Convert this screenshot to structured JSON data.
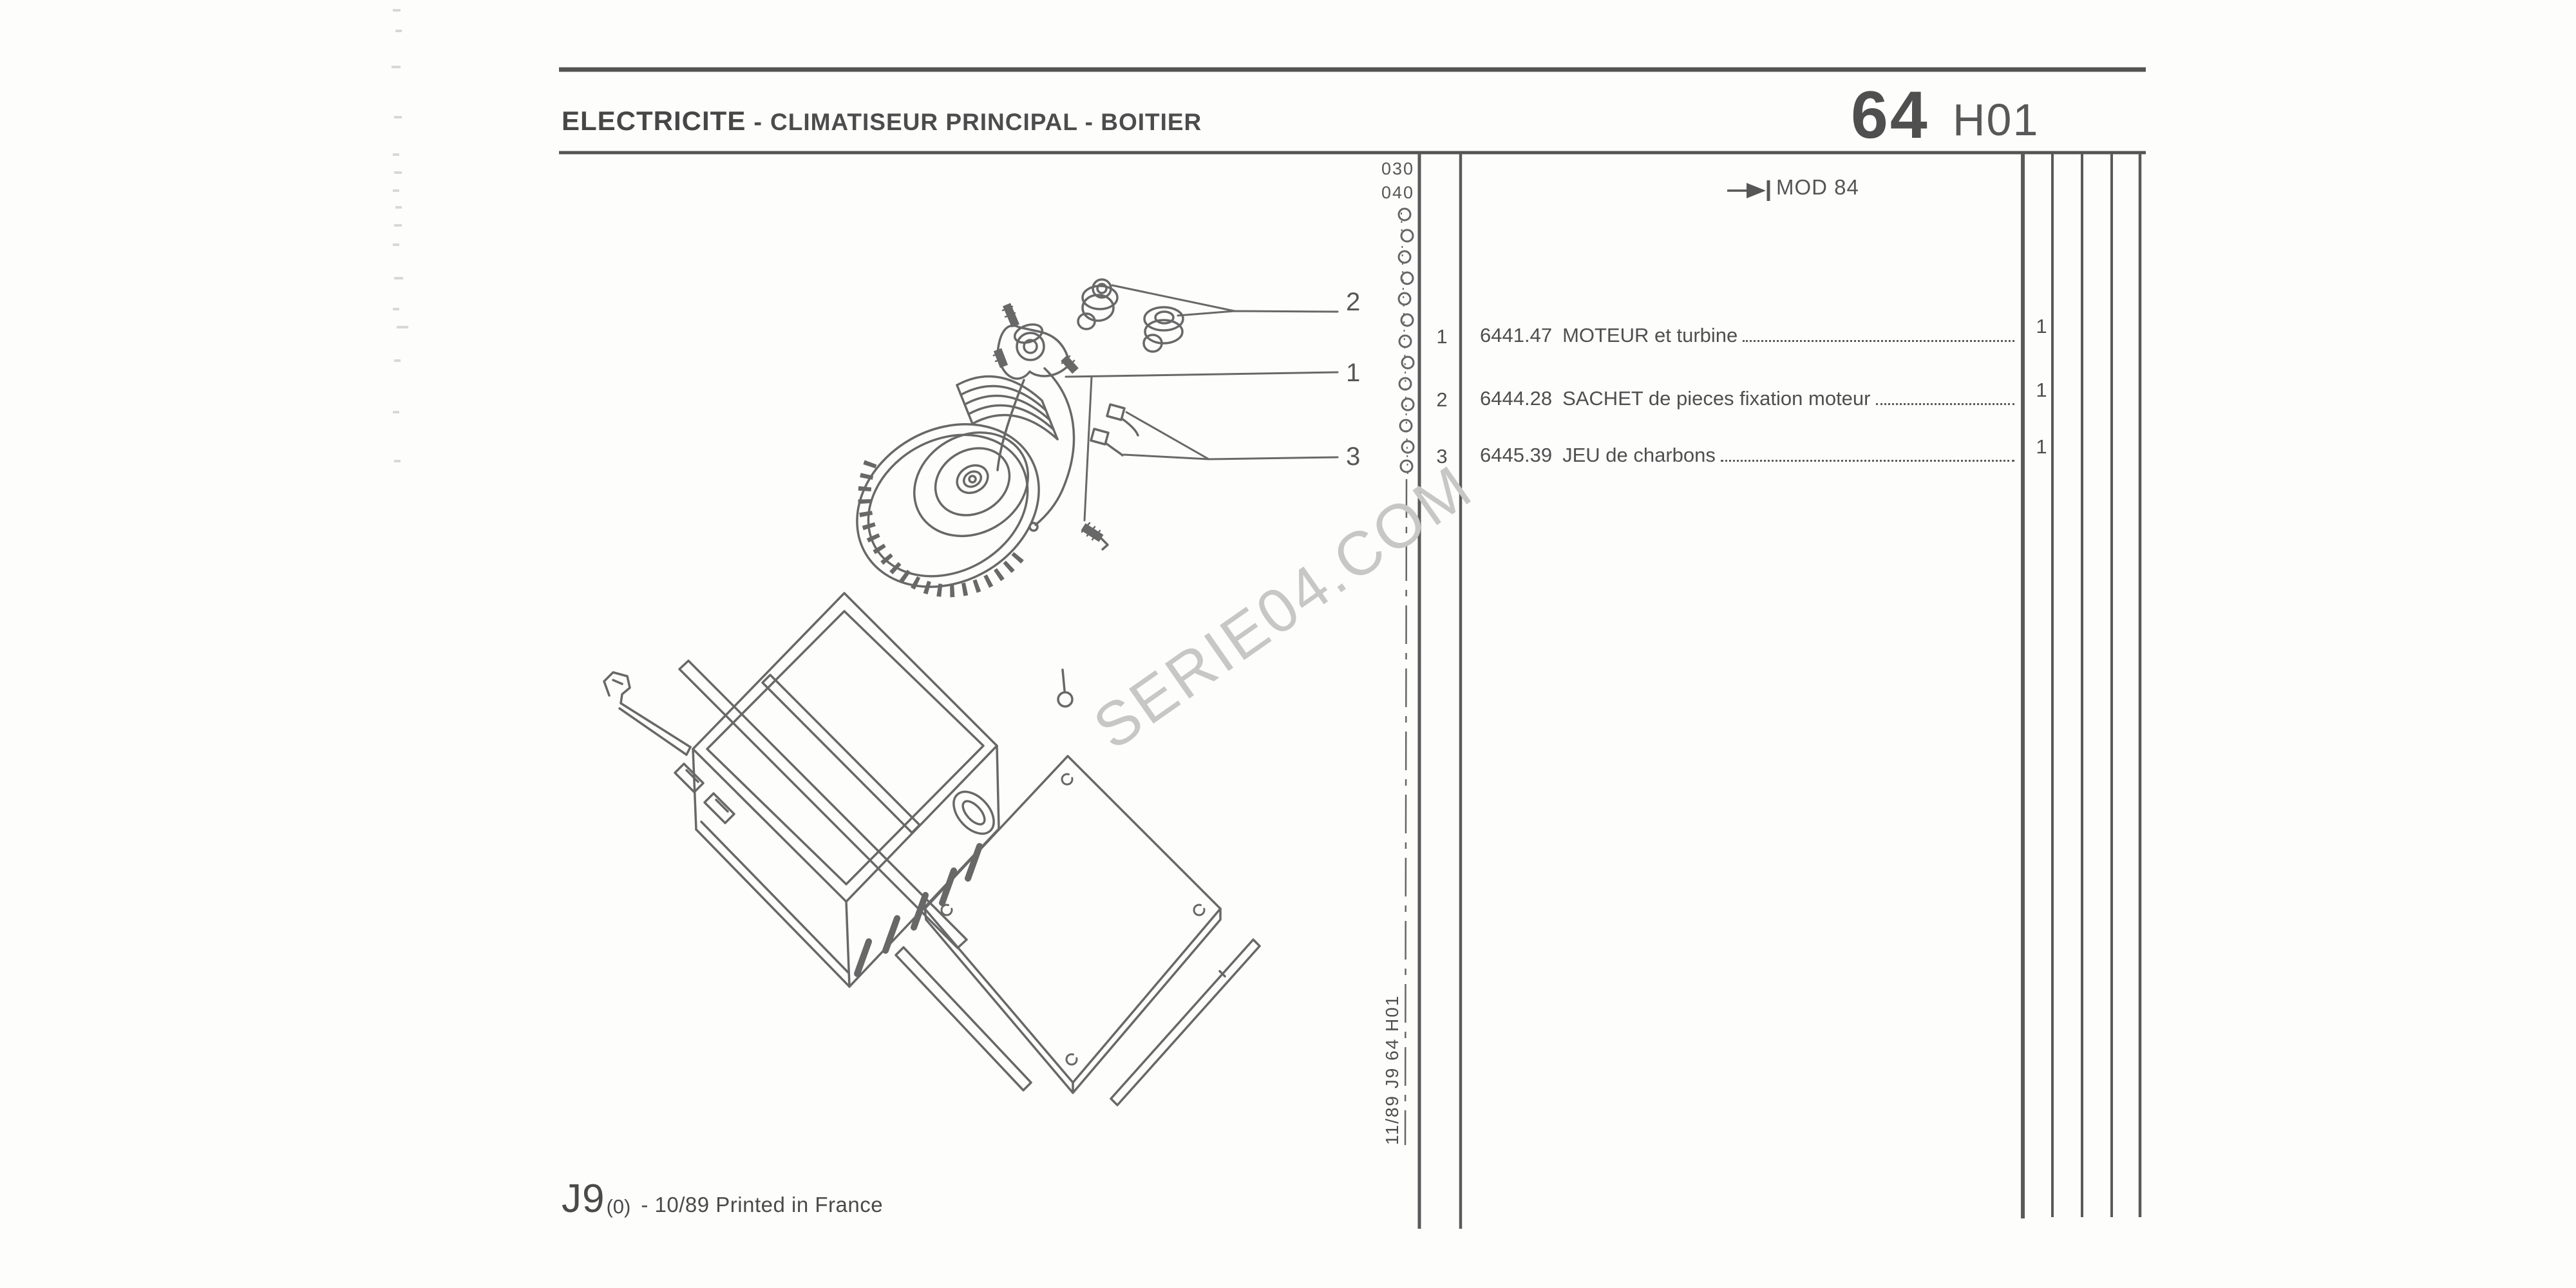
{
  "header": {
    "title_main": "ELECTRICITE",
    "title_sep": "-",
    "title_rest": "CLIMATISEUR PRINCIPAL - BOITIER",
    "page_number": "64",
    "page_code": "H01",
    "mod_note": "MOD 84"
  },
  "margin": {
    "codes": [
      "030",
      "040"
    ],
    "side_code": "11/89  J9  64 H01"
  },
  "parts_table": {
    "rows": [
      {
        "item": "1",
        "ref": "6441.47",
        "label": "MOTEUR et turbine",
        "qty": "1"
      },
      {
        "item": "2",
        "ref": "6444.28",
        "label": "SACHET de pieces fixation moteur",
        "qty": "1"
      },
      {
        "item": "3",
        "ref": "6445.39",
        "label": "JEU de charbons",
        "qty": "1"
      }
    ]
  },
  "drawing": {
    "callouts": [
      "1",
      "2",
      "3"
    ]
  },
  "watermark": {
    "text": "SERIE04.COM",
    "color": "#c7c7c6"
  },
  "footer": {
    "model": "J9",
    "variant": "(0)",
    "print_note": "- 10/89 Printed in France"
  }
}
